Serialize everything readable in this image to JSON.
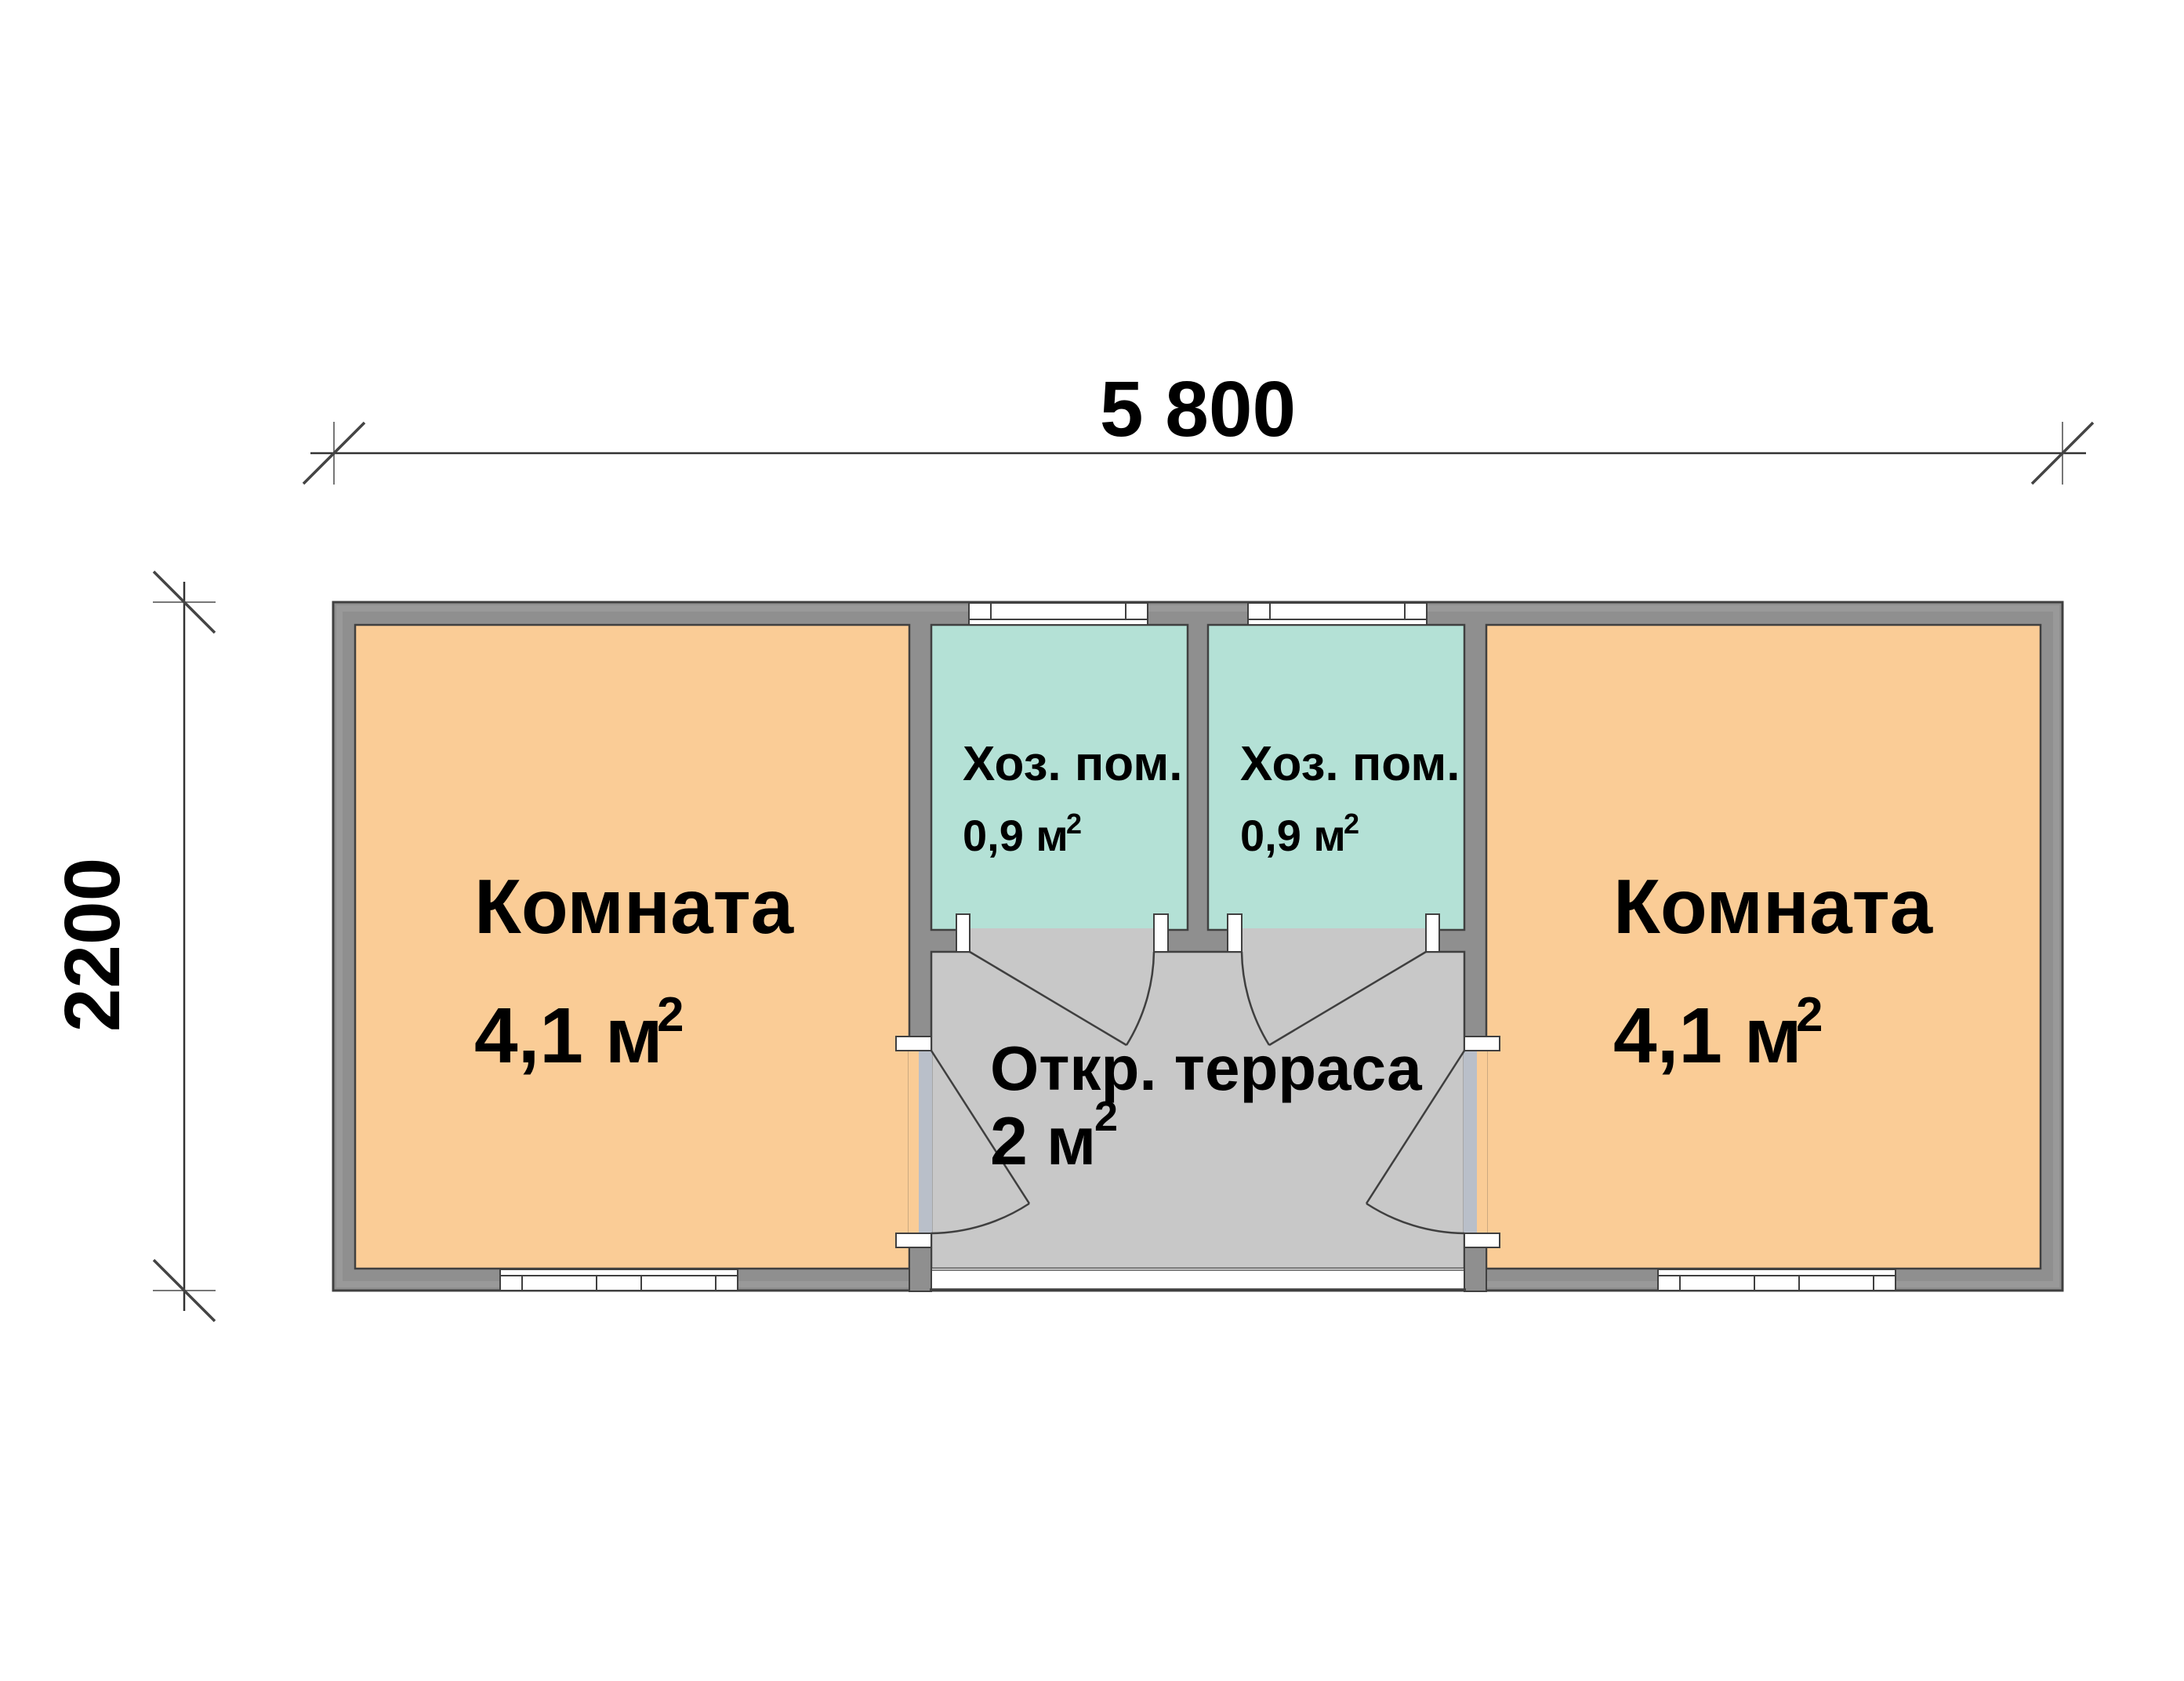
{
  "dimensions": {
    "width_label": "5 800",
    "height_label": "2200"
  },
  "rooms": {
    "room_left": {
      "label": "Комната",
      "area": "4,1 м",
      "area_sup": "2"
    },
    "room_right": {
      "label": "Комната",
      "area": "4,1 м",
      "area_sup": "2"
    },
    "utility_left": {
      "label": "Хоз. пом.",
      "area": "0,9 м",
      "area_sup": "2"
    },
    "utility_right": {
      "label": "Хоз. пом.",
      "area": "0,9 м",
      "area_sup": "2"
    },
    "terrace": {
      "label": "Откр. терраса",
      "area": "2 м",
      "area_sup": "2"
    }
  },
  "colors": {
    "page_bg": "#FFFFFF",
    "text_color": "#000000",
    "wall_fill": "#8F8F8F",
    "wall_outline": "#404040",
    "room_fill": "#FACC96",
    "utility_fill": "#B4E1D6",
    "terrace_fill": "#C8C8C8",
    "opening_fill": "#B9BFC9"
  }
}
